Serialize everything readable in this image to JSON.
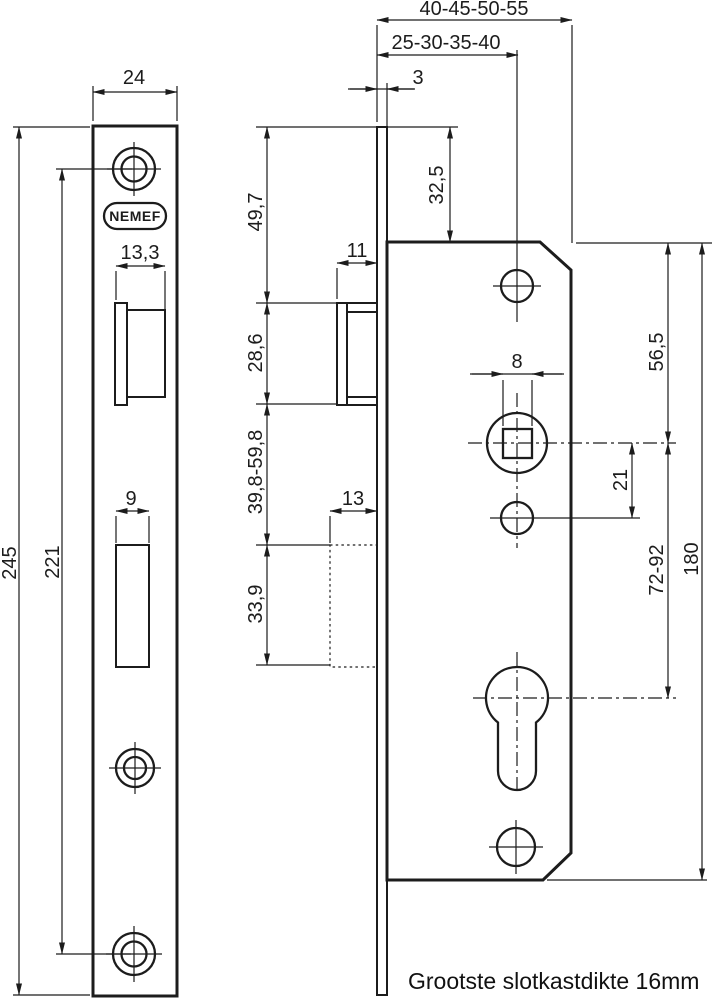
{
  "brand": {
    "logo_text": "NEMEF"
  },
  "footer": {
    "note": "Grootste slotkastdikte 16mm"
  },
  "dims": {
    "case_depth_range": "40-45-50-55",
    "backset_range": "25-30-35-40",
    "faceplate_thickness": "3",
    "faceplate_width": "24",
    "faceplate_height": "245",
    "screw_center_distance": "221",
    "latch_cutout_width": "13,3",
    "deadbolt_cutout_width": "9",
    "top_to_latch": "49,7",
    "latch_height": "28,6",
    "latch_to_deadbolt_range": "39,8-59,8",
    "deadbolt_height": "33,9",
    "latch_protrusion": "11",
    "deadbolt_protrusion": "13",
    "top_to_case": "32,5",
    "spindle_square_size": "8",
    "case_top_to_spindle": "56,5",
    "spindle_to_aux_hole": "21",
    "spindle_to_cylinder_range": "72-92",
    "case_height": "180"
  }
}
